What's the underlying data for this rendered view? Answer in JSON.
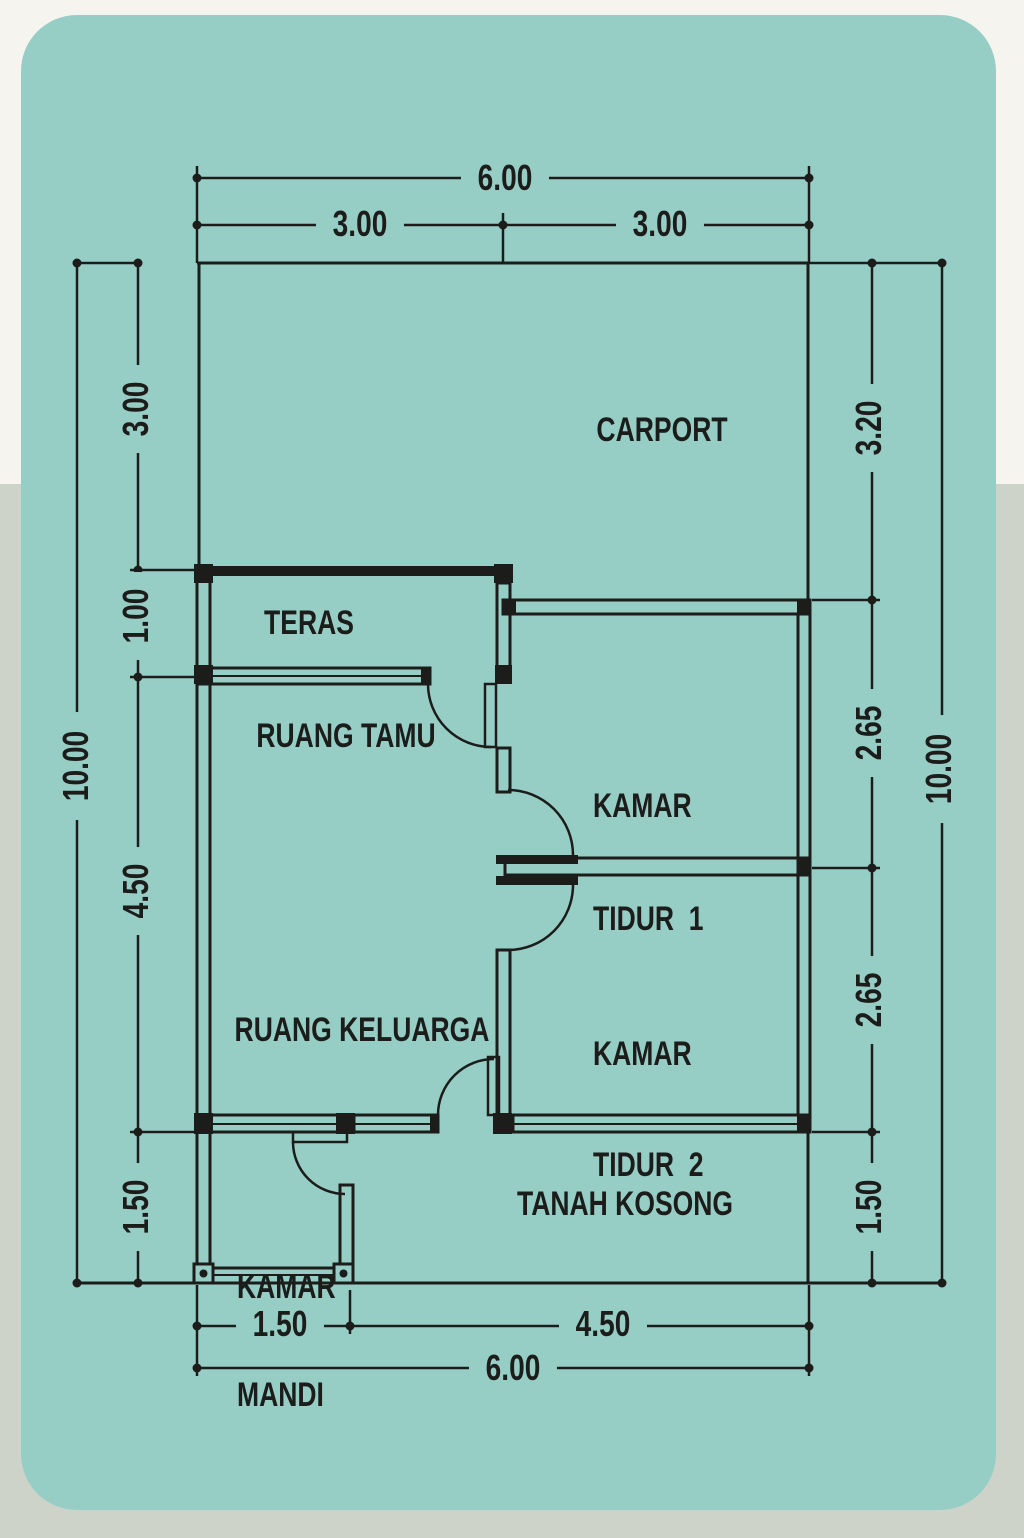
{
  "colors": {
    "card": "#96cec6",
    "background_top": "#f5f4ee",
    "background_bottom": "#cdd3c9",
    "line": "#1c1c1a"
  },
  "rooms": {
    "carport": "CARPORT",
    "teras": "TERAS",
    "ruang_tamu": "RUANG TAMU",
    "kamar_tidur_1": {
      "line1": "KAMAR",
      "line2": "TIDUR  1"
    },
    "kamar_tidur_2": {
      "line1": "KAMAR",
      "line2": "TIDUR  2"
    },
    "ruang_keluarga": "RUANG KELUARGA",
    "kamar_mandi": {
      "line1": "KAMAR",
      "line2": "MANDI"
    },
    "tanah_kosong": "TANAH KOSONG"
  },
  "dimensions": {
    "top": {
      "total": "6.00",
      "left": "3.00",
      "right": "3.00"
    },
    "bottom": {
      "left": "1.50",
      "right": "4.50",
      "total": "6.00"
    },
    "left": {
      "a": "3.00",
      "b": "1.00",
      "c": "4.50",
      "d": "1.50",
      "total": "10.00"
    },
    "right": {
      "a": "3.20",
      "b": "2.65",
      "c": "2.65",
      "d": "1.50",
      "total": "10.00"
    }
  }
}
